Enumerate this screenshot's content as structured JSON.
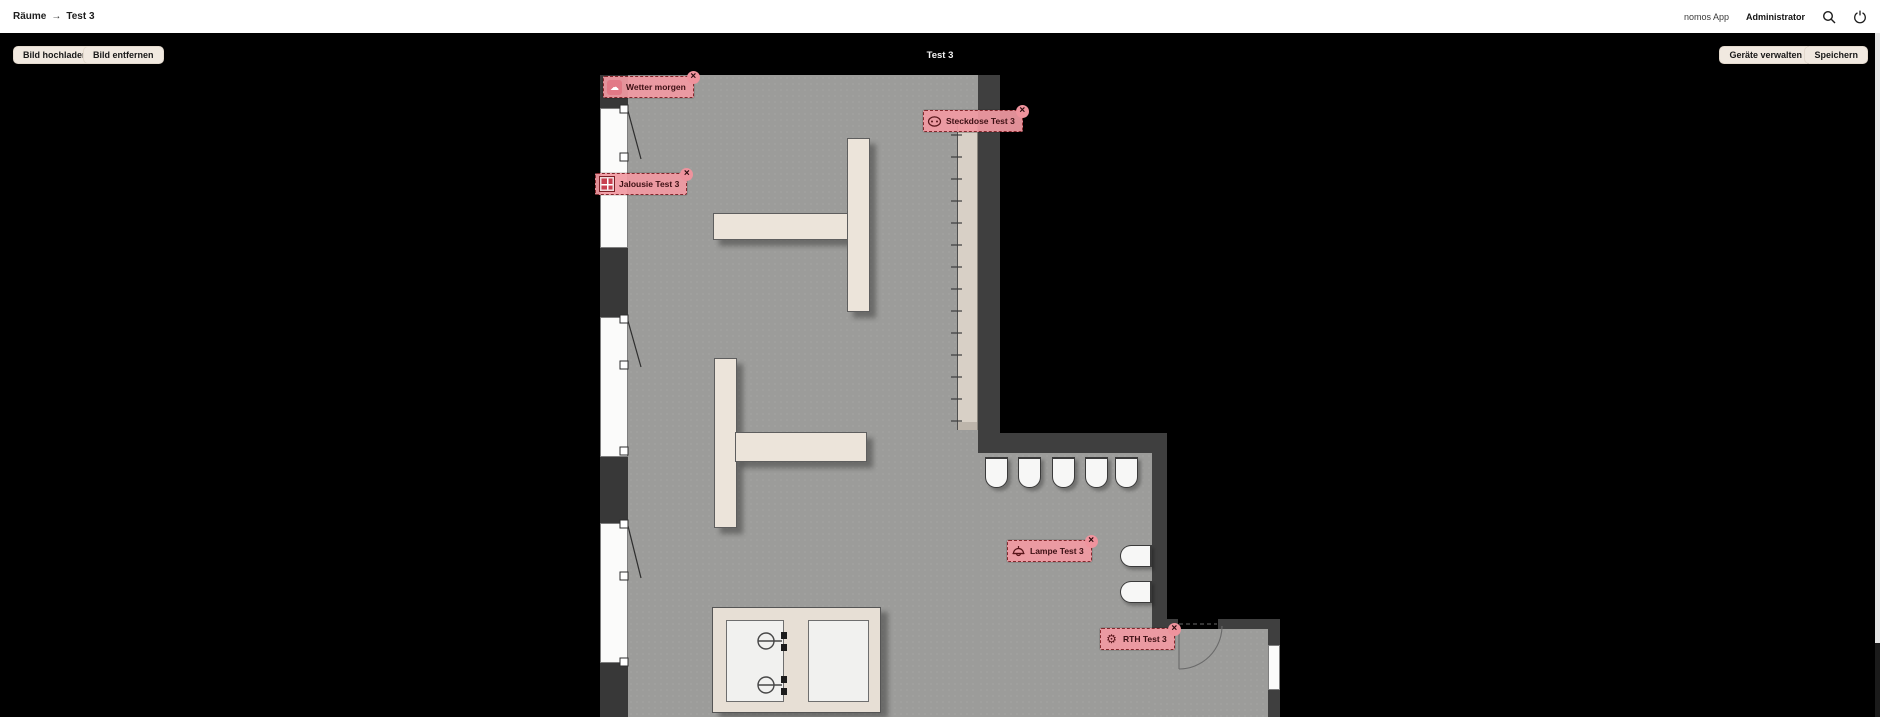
{
  "header": {
    "breadcrumb": {
      "root": "Räume",
      "separator": "→",
      "current": "Test 3"
    },
    "app_name": "nomos App",
    "user_name": "Administrator"
  },
  "toolbar": {
    "upload_image": "Bild hochladen",
    "remove_image": "Bild entfernen",
    "room_title": "Test 3",
    "manage_devices": "Geräte verwalten",
    "save": "Speichern"
  },
  "plan": {
    "tags": [
      {
        "label": "Wetter morgen",
        "icon": "cloud-icon",
        "close": "×"
      },
      {
        "label": "Steckdose Test 3",
        "icon": "socket-icon",
        "close": "×"
      },
      {
        "label": "Jalousie Test 3",
        "icon": "blinds-icon",
        "close": "×"
      },
      {
        "label": "Lampe Test 3",
        "icon": "lamp-icon",
        "close": "×"
      },
      {
        "label": "RTH Test 3",
        "icon": "gear-icon",
        "close": "×"
      }
    ]
  },
  "glyphs": {
    "cloud": "☁",
    "gear": "⚙"
  },
  "colors": {
    "accent_pink": "#f19aa3",
    "tag_border": "#84272c",
    "button_bg": "#f1e9e0",
    "floor": "#9c9c9a",
    "wall": "#3f3f3f",
    "canvas": "#000000"
  }
}
